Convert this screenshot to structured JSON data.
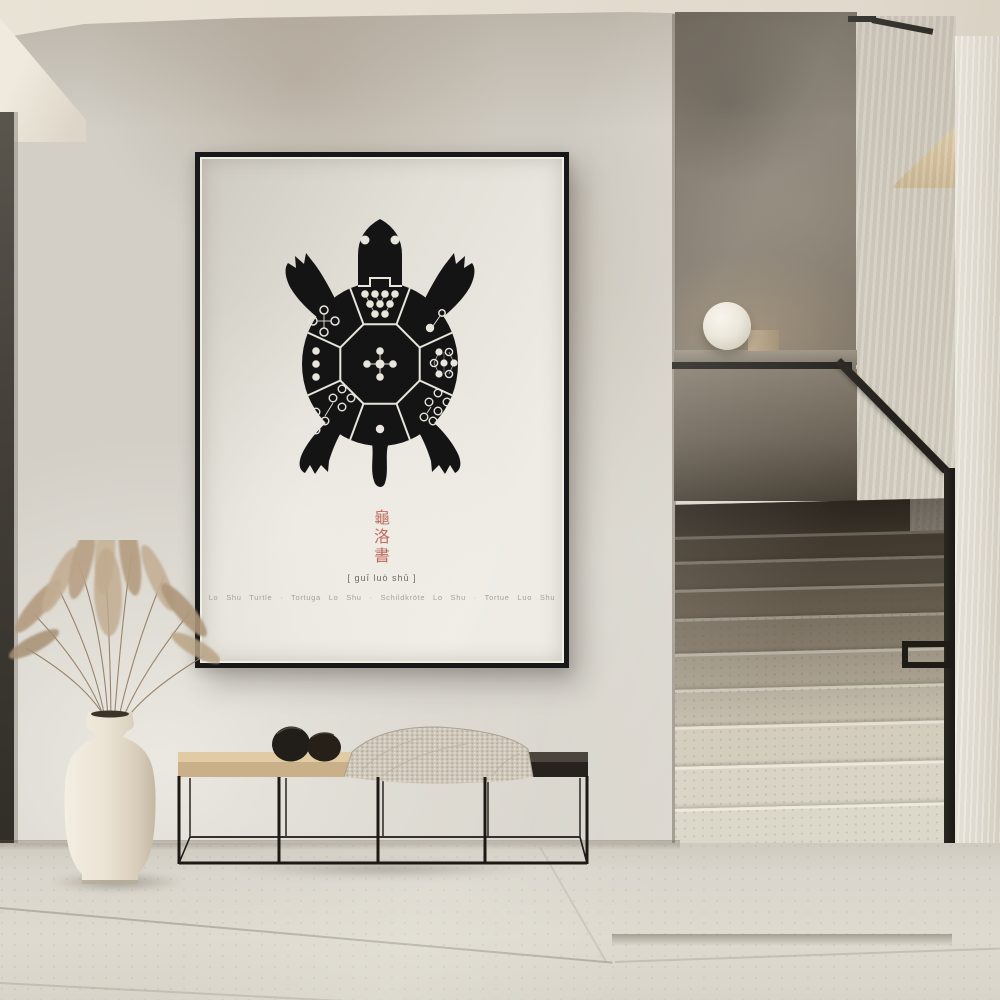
{
  "scene": {
    "description": "Minimal hallway interior with a framed Lo Shu turtle art print above a bench, a vase of dried pampas grass, a sphere lamp and a terrazzo staircase with black handrail",
    "objects": [
      "framed-poster",
      "lo-shu-turtle-illustration",
      "bench",
      "blanket",
      "decor-pebbles",
      "vase",
      "pampas-grass",
      "sphere-lamp",
      "staircase",
      "glass-balustrade",
      "handrail",
      "wall-niche"
    ]
  },
  "poster": {
    "title_characters": [
      "龜",
      "洛",
      "書"
    ],
    "pinyin": "[ guī luò shū ]",
    "caption_line": "Lo Shu Turtle · Tortuga Lo Shu · Schildkröte Lo Shu · Tortue Luo Shu",
    "captions": [
      "Lo Shu Turtle",
      "Tortuga Lo Shu",
      "Schildkröte Lo Shu",
      "Tortue Luo Shu"
    ],
    "lo_shu_dot_counts": {
      "top": 9,
      "top_right": 2,
      "right": 7,
      "bottom_right": 6,
      "bottom": 1,
      "bottom_left": 8,
      "left": 3,
      "top_left": 4,
      "center": 5
    },
    "lo_shu_grid": [
      [
        4,
        9,
        2
      ],
      [
        3,
        5,
        7
      ],
      [
        8,
        1,
        6
      ]
    ]
  },
  "colors": {
    "accent_red": "#bf6a5d",
    "poster_paper": "#e9e6de",
    "frame_black": "#181818",
    "turtle_black": "#141414",
    "dot_white": "#e8e5dd",
    "wall_plaster": "#d3cfc7",
    "stair_terrazzo": "#ddd9ca",
    "bench_wood_light": "#d8c09a",
    "bench_wood_dark": "#35302a",
    "metal_black": "#1f1c17",
    "vase_cream": "#ece5d8"
  }
}
